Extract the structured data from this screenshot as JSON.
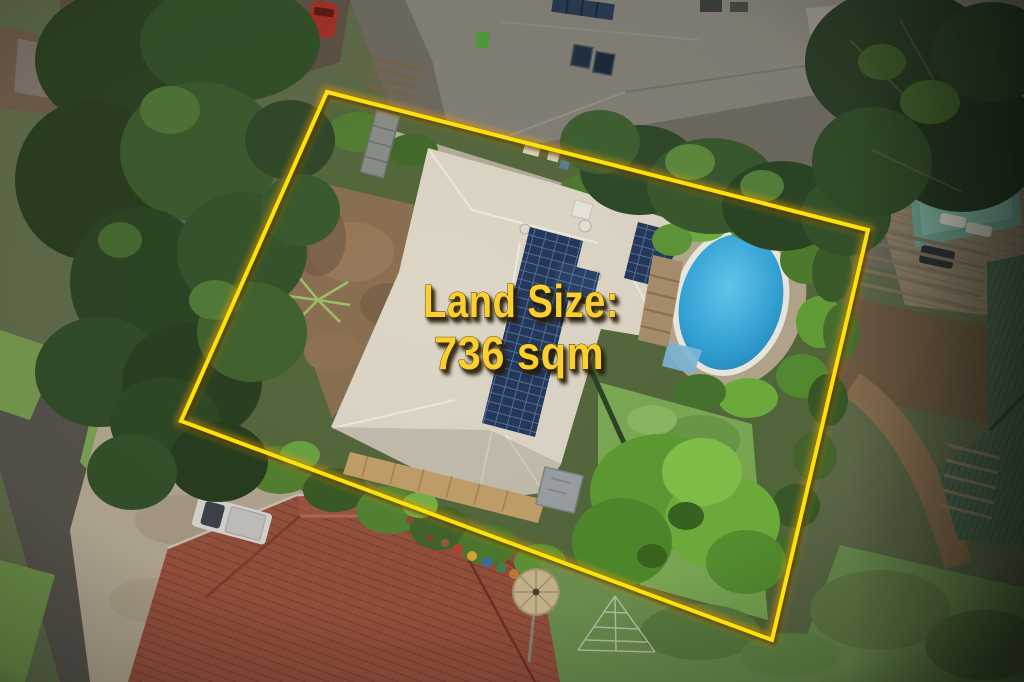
{
  "overlay": {
    "land_size_label": "Land Size:",
    "land_size_value": "736 sqm"
  },
  "colors": {
    "text_yellow": "#fccf30",
    "boundary_yellow": "#ffe10a",
    "boundary_glow": "#ffa600",
    "subject_roof": "#ddd6c6",
    "solar_panel": "#24395c",
    "pool_water": "#2f9fd2",
    "pool_coping": "#eceae2",
    "pool_gravel": "#b4a78c",
    "foreground_roof": "#95503c",
    "neighbor_roof_gray": "#838076",
    "neighbor_roof_teal": "#4c6a50",
    "neighbor_pool": "#6fa191",
    "neighbor_deck": "#8f8168",
    "lawn_green": "#7caa55",
    "neighbor_lawn": "#6d9150",
    "shrub_green": "#6fae3f",
    "tree_dark_green": "#2c4123",
    "dirt_brown": "#8a6f52",
    "road_asphalt": "#55524b",
    "concrete_driveway": "#b2a691",
    "vehicle_white": "#d6d5d0"
  }
}
